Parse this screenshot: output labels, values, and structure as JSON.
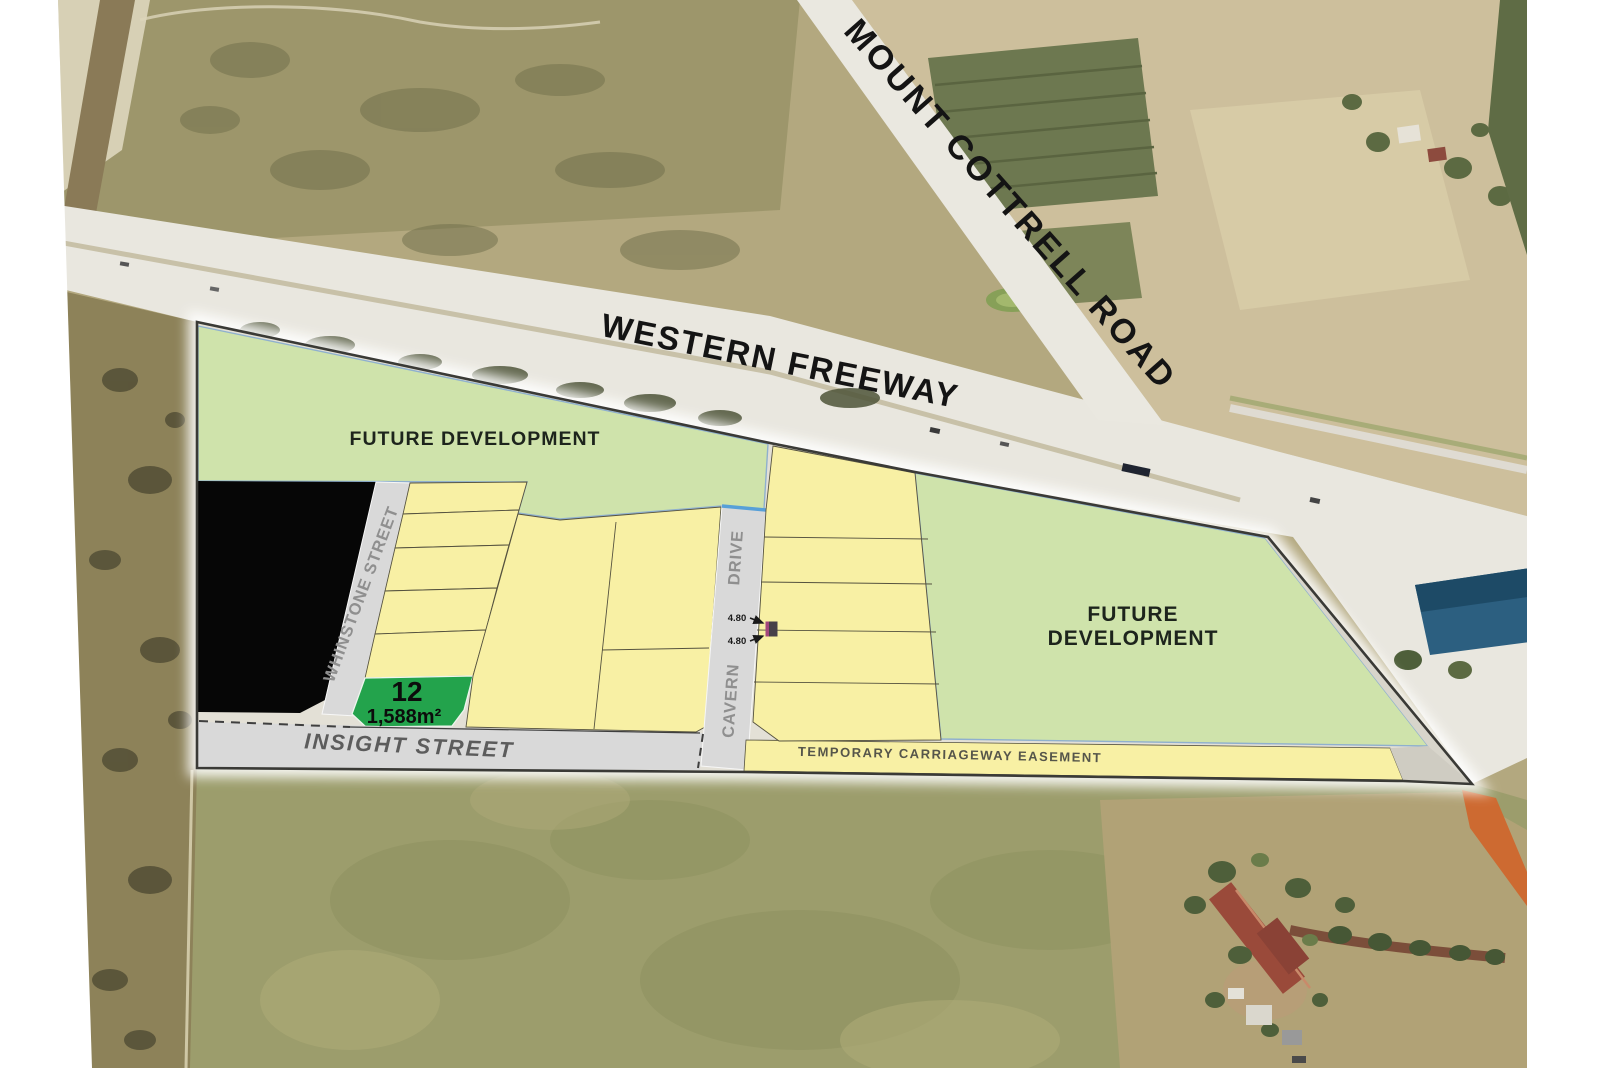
{
  "labels": {
    "freeway": "WESTERN FREEWAY",
    "cottrell_road": "MOUNT COTTRELL ROAD",
    "future_dev_left": "FUTURE DEVELOPMENT",
    "future_dev_right_line1": "FUTURE",
    "future_dev_right_line2": "DEVELOPMENT",
    "whinstone_street": "WHINSTONE STREET",
    "cavern_word": "CAVERN",
    "drive_word": "DRIVE",
    "insight_street": "INSIGHT STREET",
    "easement": "TEMPORARY CARRIAGEWAY EASEMENT"
  },
  "lot": {
    "number": "12",
    "area": "1,588m²"
  },
  "dimensions": {
    "top": "4.80",
    "bottom": "4.80"
  },
  "colors": {
    "future_green": "#cfe3ab",
    "lot_yellow": "#f8f0a4",
    "lot12_green": "#23a34c",
    "street_gray": "#d9d9d9",
    "sold_black": "#060606",
    "boundary_dark": "#3a3a36",
    "blue_edge": "#8fb0ce",
    "cavern_cap_blue": "#57a0d8"
  }
}
